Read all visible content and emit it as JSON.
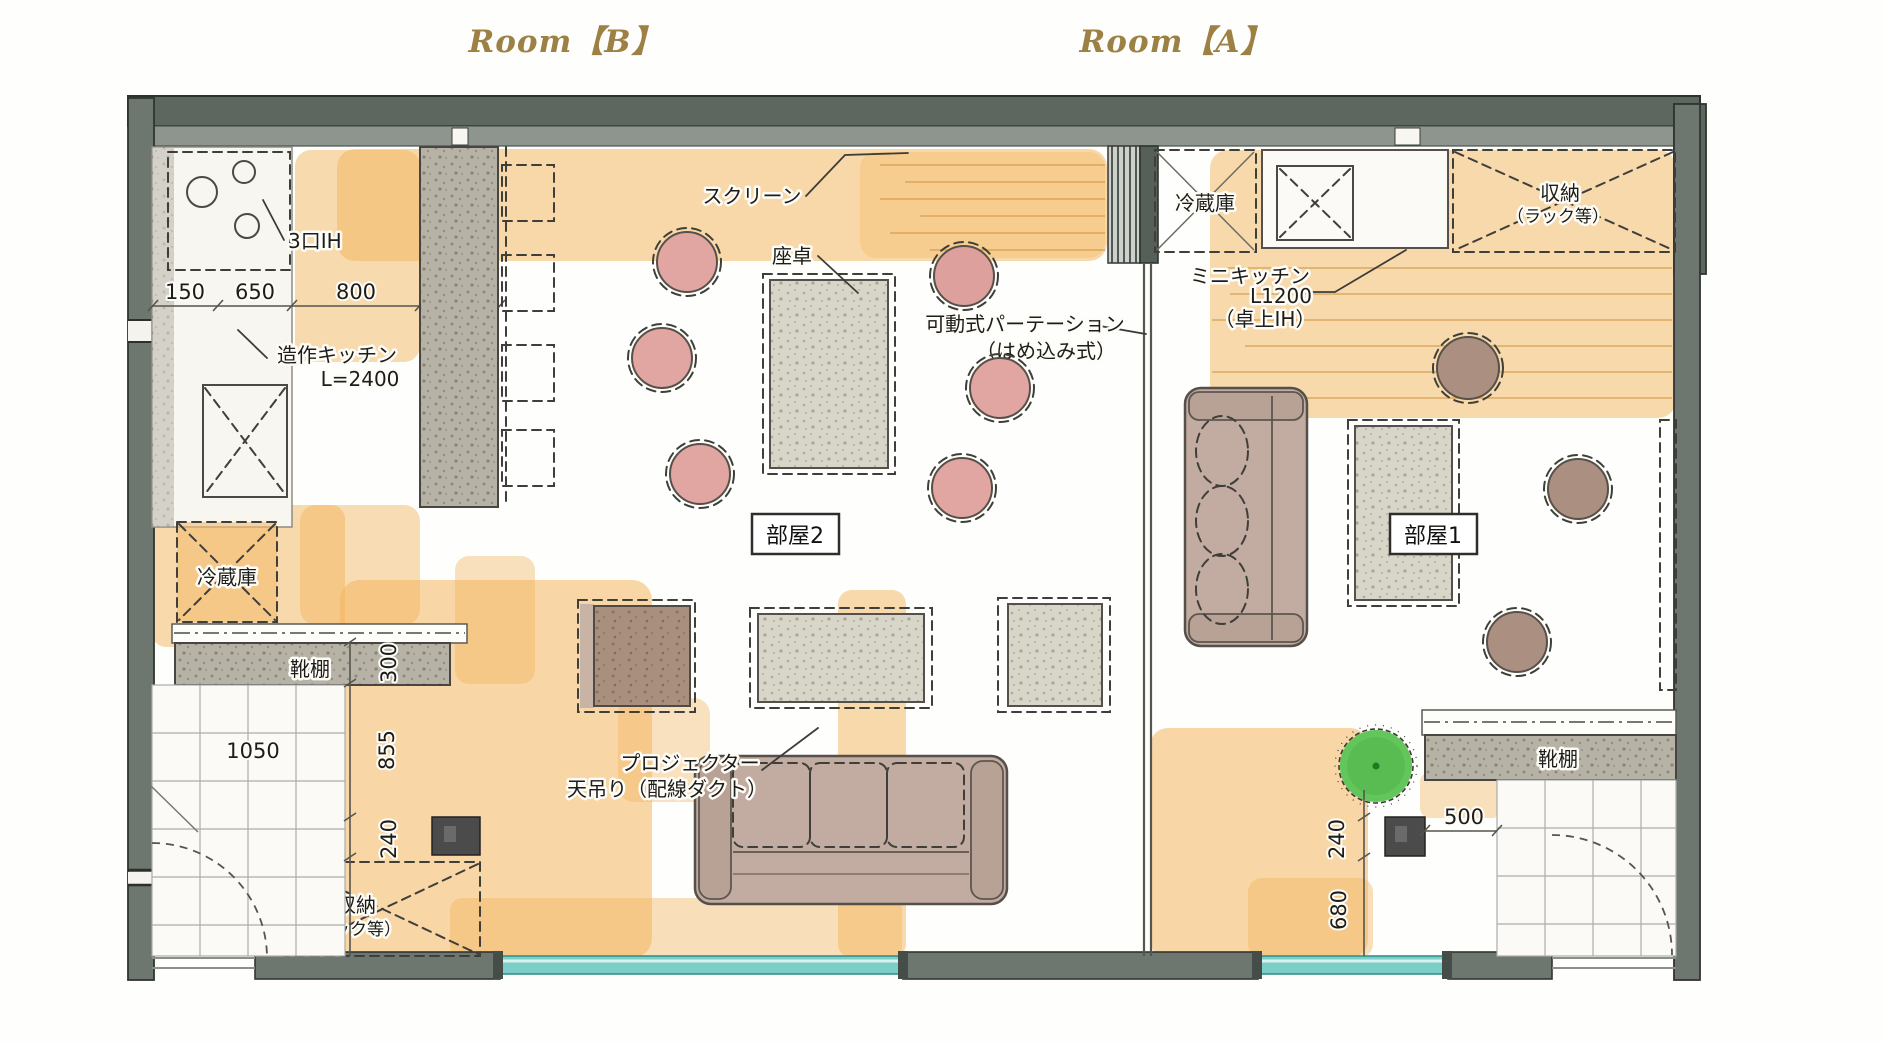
{
  "titles": {
    "room_b": "Room【B】",
    "room_a": "Room【A】"
  },
  "partition": {
    "label_line1": "可動式パーテーション",
    "label_line2": "（はめ込み式）"
  },
  "room_b": {
    "tag": "部屋2",
    "labels": {
      "screen": "スクリーン",
      "low_table": "座卓",
      "ih": "3口IH",
      "kitchen_line1": "造作キッチン",
      "kitchen_line2": "L=2400",
      "fridge": "冷蔵庫",
      "shoe_shelf": "靴棚",
      "storage_line1": "収納",
      "storage_line2": "（ラック等）",
      "projector_line1": "プロジェクター",
      "projector_line2": "天吊り（配線ダクト）"
    },
    "dims": {
      "d150": "150",
      "d650": "650",
      "d800": "800",
      "d500": "500",
      "d300": "300",
      "d1050": "1050",
      "d855": "855",
      "d240": "240"
    }
  },
  "room_a": {
    "tag": "部屋1",
    "labels": {
      "fridge": "冷蔵庫",
      "minikitchen_line1": "ミニキッチン",
      "minikitchen_line2": "L1200",
      "minikitchen_line3": "（卓上IH）",
      "storage_line1": "収納",
      "storage_line2": "（ラック等）",
      "shoe_shelf": "靴棚"
    },
    "dims": {
      "d240": "240",
      "d680": "680",
      "d500": "500"
    }
  },
  "colors": {
    "title_gold": "#9d8144",
    "wall_grey": "#5d665f",
    "floor_orange": "#f2b45c",
    "window_teal": "#7ccfc8",
    "cushion_pink": "#e2a6a2",
    "cushion_brown": "#ab8f80",
    "plant_green": "#5ec157"
  }
}
